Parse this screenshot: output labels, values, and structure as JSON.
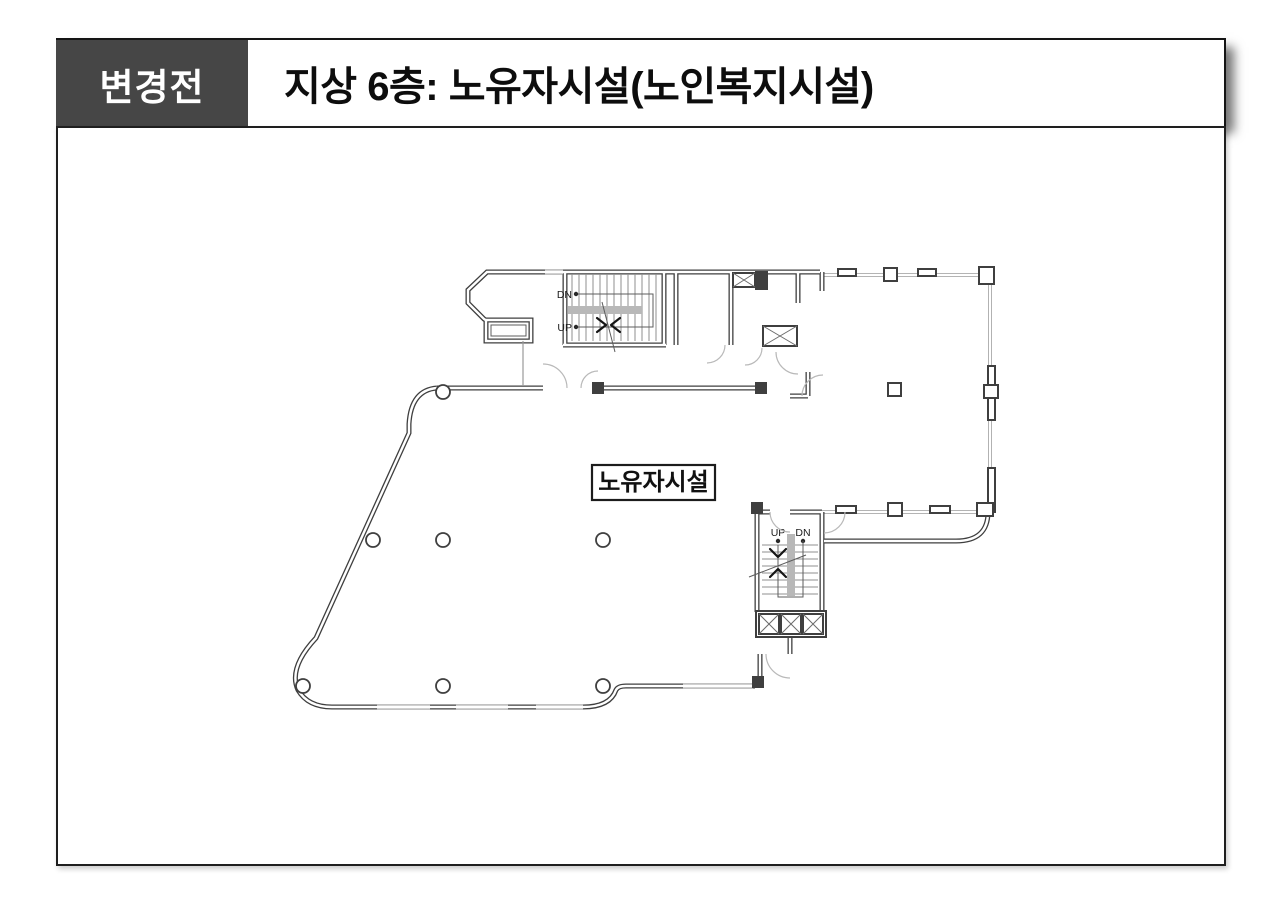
{
  "header": {
    "badge": "변경전",
    "title": "지상 6층: 노유자시설(노인복지시설)"
  },
  "plan": {
    "room_label": "노유자시설",
    "upper_stair": {
      "dn": "DN",
      "up": "UP"
    },
    "lower_stair": {
      "up": "UP",
      "dn": "DN"
    }
  },
  "colors": {
    "badge_bg": "#464646",
    "badge_text": "#ffffff",
    "wall": "#3f3f3f",
    "glass": "#a9a9a9",
    "stair_band": "#b8b8b8",
    "frame_border": "#1f1f1f"
  }
}
